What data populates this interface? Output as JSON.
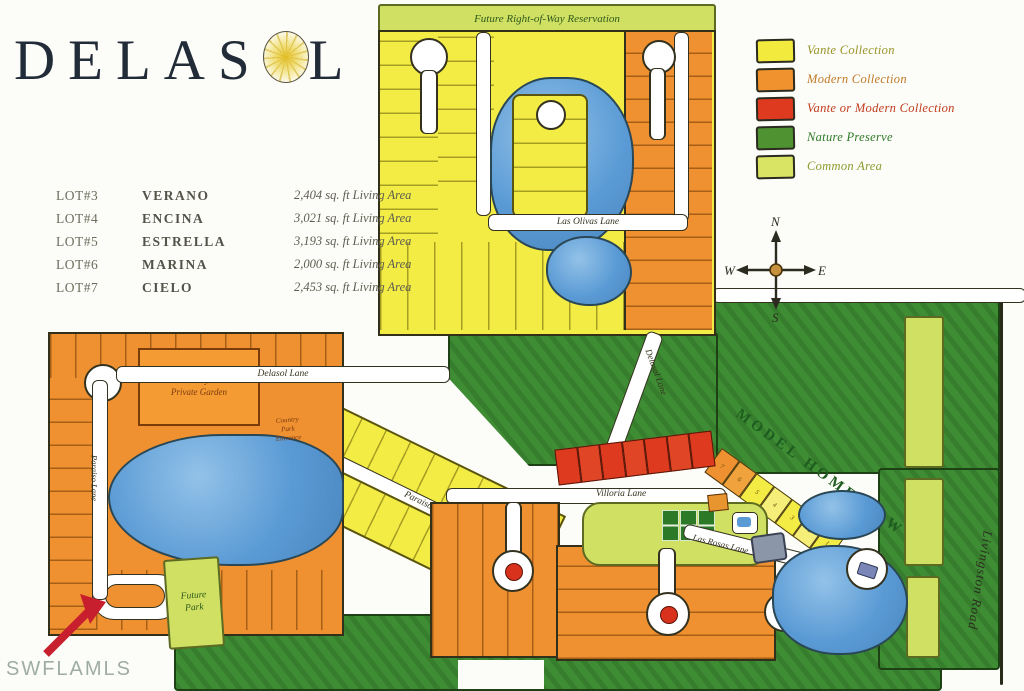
{
  "title": {
    "pre": "DELAS",
    "post": "L",
    "sun_icon": "sun-logo"
  },
  "watermark": "SWFLAMLS",
  "lot_table": [
    {
      "lot": "LOT#3",
      "name": "VERANO",
      "area": "2,404 sq. ft  Living Area"
    },
    {
      "lot": "LOT#4",
      "name": "ENCINA",
      "area": "3,021 sq. ft  Living Area"
    },
    {
      "lot": "LOT#5",
      "name": "ESTRELLA",
      "area": "3,193 sq. ft  Living Area"
    },
    {
      "lot": "LOT#6",
      "name": "MARINA",
      "area": "2,000 sq. ft  Living Area"
    },
    {
      "lot": "LOT#7",
      "name": "CIELO",
      "area": "2,453 sq. ft  Living Area"
    }
  ],
  "legend": [
    {
      "label": "Vante Collection",
      "color": "#f2ea3d",
      "text_color": "#9a9428"
    },
    {
      "label": "Modern Collection",
      "color": "#f0922d",
      "text_color": "#bf7a28"
    },
    {
      "label": "Vante or Modern Collection",
      "color": "#dd3a1f",
      "text_color": "#c23b1d"
    },
    {
      "label": "Nature Preserve",
      "color": "#4e9232",
      "text_color": "#2f7a27"
    },
    {
      "label": "Common Area",
      "color": "#d9e464",
      "text_color": "#8e9a2e"
    }
  ],
  "compass": {
    "north": "N",
    "south": "S",
    "east": "E",
    "west": "W"
  },
  "map_labels": {
    "future_row": "Future Right-of-Way Reservation",
    "las_olivas": "Las Olivas Lane",
    "delasol_1": "Delasol Lane",
    "delasol_2": "Delasol Lane",
    "paraiso_1": "Paraiso Lane",
    "paraiso_2": "Paraiso Lane",
    "villoria": "Villoria Lane",
    "las_rosas": "Las Rosas Lane",
    "model_home_row": "MODEL HOME ROW",
    "livingston": "Livingston Road",
    "future_park_1": "Future",
    "future_park_2": "Park",
    "entry_garden_1": "Entry",
    "entry_garden_2": "Private Garden",
    "country_park_1": "Country",
    "country_park_2": "Park",
    "country_park_3": "Entrance"
  },
  "model_home_lots": [
    "7",
    "6",
    "5",
    "4",
    "3",
    "2",
    "1"
  ],
  "colors": {
    "lake": "#5b9bd5",
    "nature_preserve": "#3e8c33",
    "common_area": "#cfe063",
    "vante_yellow": "#f3ec45",
    "modern_orange": "#ef9130",
    "vante_or_modern_red": "#dd3a1f",
    "road": "#ffffff",
    "arrow_red": "#c81f2e",
    "title_navy": "#222c38"
  }
}
